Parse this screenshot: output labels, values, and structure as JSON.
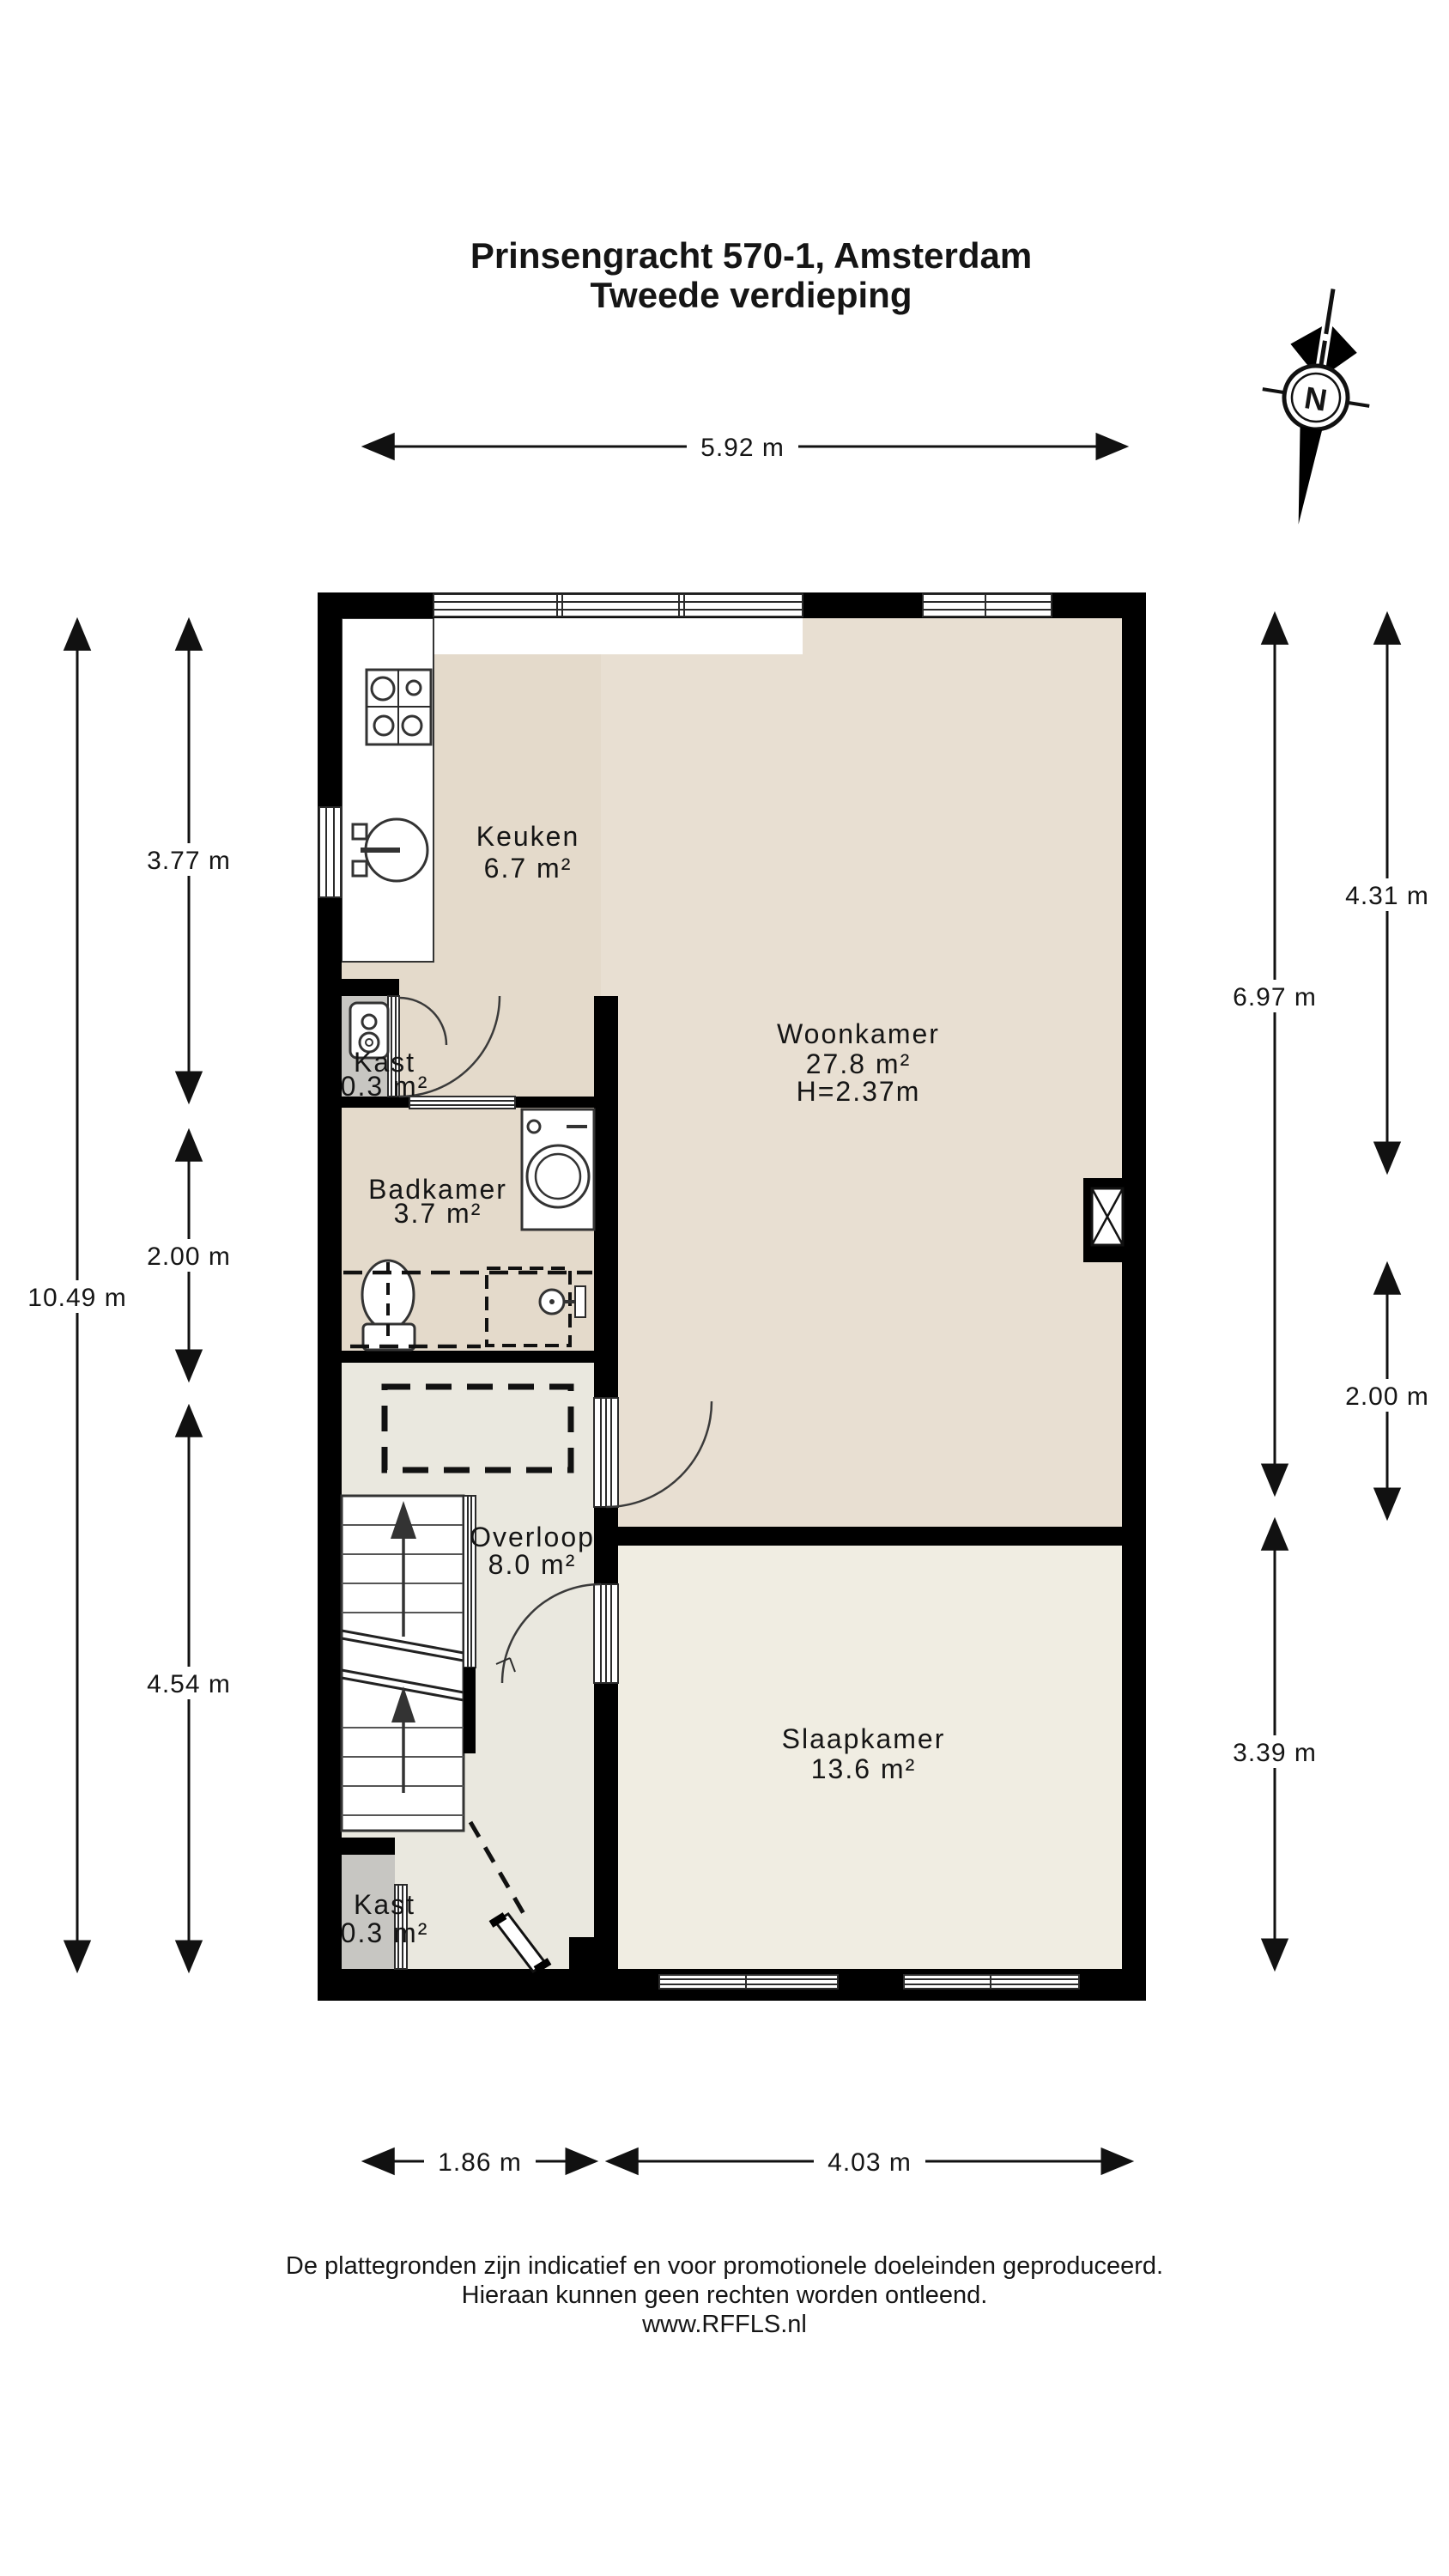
{
  "title": {
    "line1": "Prinsengracht 570-1, Amsterdam",
    "line2": "Tweede verdieping"
  },
  "compass": {
    "n": "N"
  },
  "rooms": {
    "keuken": {
      "name": "Keuken",
      "area": "6.7 m²"
    },
    "woonkamer": {
      "name": "Woonkamer",
      "area": "27.8 m²",
      "height": "H=2.37m"
    },
    "kast1": {
      "name": "Kast",
      "area": "0.3 m²"
    },
    "badkamer": {
      "name": "Badkamer",
      "area": "3.7 m²"
    },
    "overloop": {
      "name": "Overloop",
      "area": "8.0 m²"
    },
    "slaapkamer": {
      "name": "Slaapkamer",
      "area": "13.6 m²"
    },
    "kast2": {
      "name": "Kast",
      "area": "0.3 m²"
    }
  },
  "dimensions": {
    "width_total": "5.92 m",
    "bottom_left": "1.86 m",
    "bottom_right": "4.03 m",
    "left_total": "10.49 m",
    "left_top": "3.77 m",
    "left_mid": "2.00 m",
    "left_bottom": "4.54 m",
    "right_living": "6.97 m",
    "right_bedroom": "3.39 m",
    "right_top": "4.31 m",
    "right_mid": "2.00 m"
  },
  "footer": {
    "line1": "De plattegronden zijn indicatief en voor promotionele doeleinden geproduceerd.",
    "line2": "Hieraan kunnen geen rechten worden ontleend.",
    "line3": "www.RFFLS.nl"
  },
  "colors": {
    "wall": "#000000",
    "floor_kitchen": "#e4dacb",
    "floor_living": "#e8dfd2",
    "floor_bathroom": "#e4dacb",
    "floor_hall": "#eae8df",
    "floor_bedroom": "#f0ede2",
    "floor_closet": "#c7c6c2",
    "line": "#111111"
  }
}
